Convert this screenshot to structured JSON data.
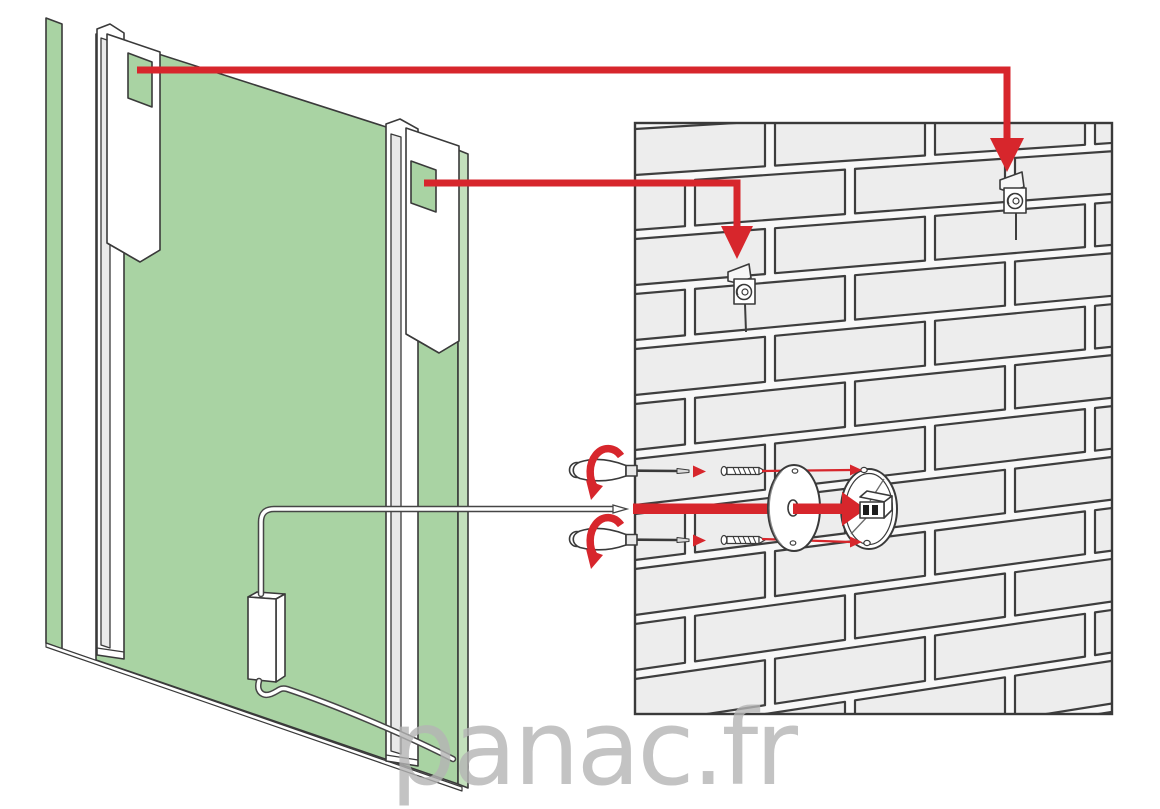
{
  "watermark": {
    "text": "panac.fr"
  },
  "colors": {
    "background": "#ffffff",
    "panel_green": "#a9d3a3",
    "panel_green_edge": "#c3e0bc",
    "outline": "#3a3a3a",
    "arrow_red": "#d7262c",
    "brick_fill": "#ededed",
    "brick_line": "#3e3e3e",
    "wall_mortar": "#f8f8f8",
    "hardware_white": "#ffffff",
    "shade_gray": "#e9e9e9",
    "cable_gray": "#454545",
    "watermark_gray": "#b5b5b5"
  },
  "parts": {
    "mirror_back_panel": "mirror-back-panel",
    "hanging_rail_left": "hanging-rail-left",
    "hanging_rail_right": "hanging-rail-right",
    "rail_cutout": "rail-bracket-cutout",
    "wall": "brick-wall",
    "wall_bracket_left": "wall-bracket-left",
    "wall_bracket_right": "wall-bracket-right",
    "driver_box": "driver-box",
    "power_cable": "power-cable",
    "screwdriver": "screwdriver",
    "screw": "wall-screw",
    "cover_disc": "cable-cover-disc",
    "junction_box": "wall-junction-box"
  }
}
